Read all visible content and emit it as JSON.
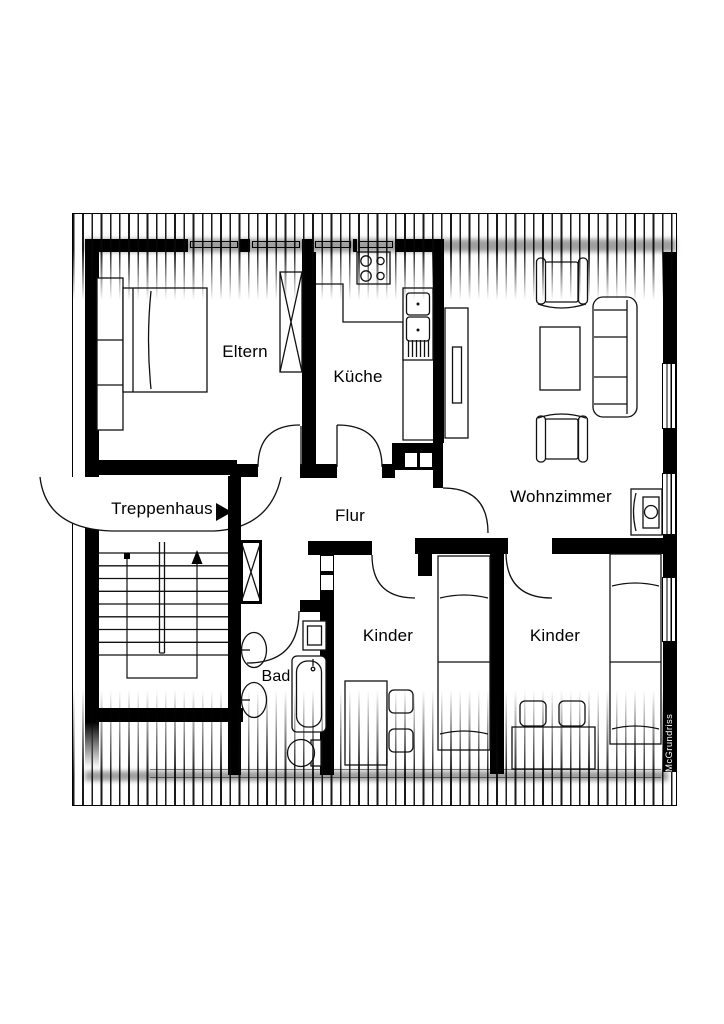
{
  "plan": {
    "rooms": {
      "eltern": "Eltern",
      "kueche": "Küche",
      "wohnzimmer": "Wohnzimmer",
      "treppenhaus": "Treppenhaus",
      "flur": "Flur",
      "kinder_left": "Kinder",
      "kinder_right": "Kinder",
      "bad": "Bad"
    },
    "credit": "McGrundriss",
    "colors": {
      "wall": "#000000",
      "line": "#111111",
      "paper": "#ffffff"
    }
  }
}
